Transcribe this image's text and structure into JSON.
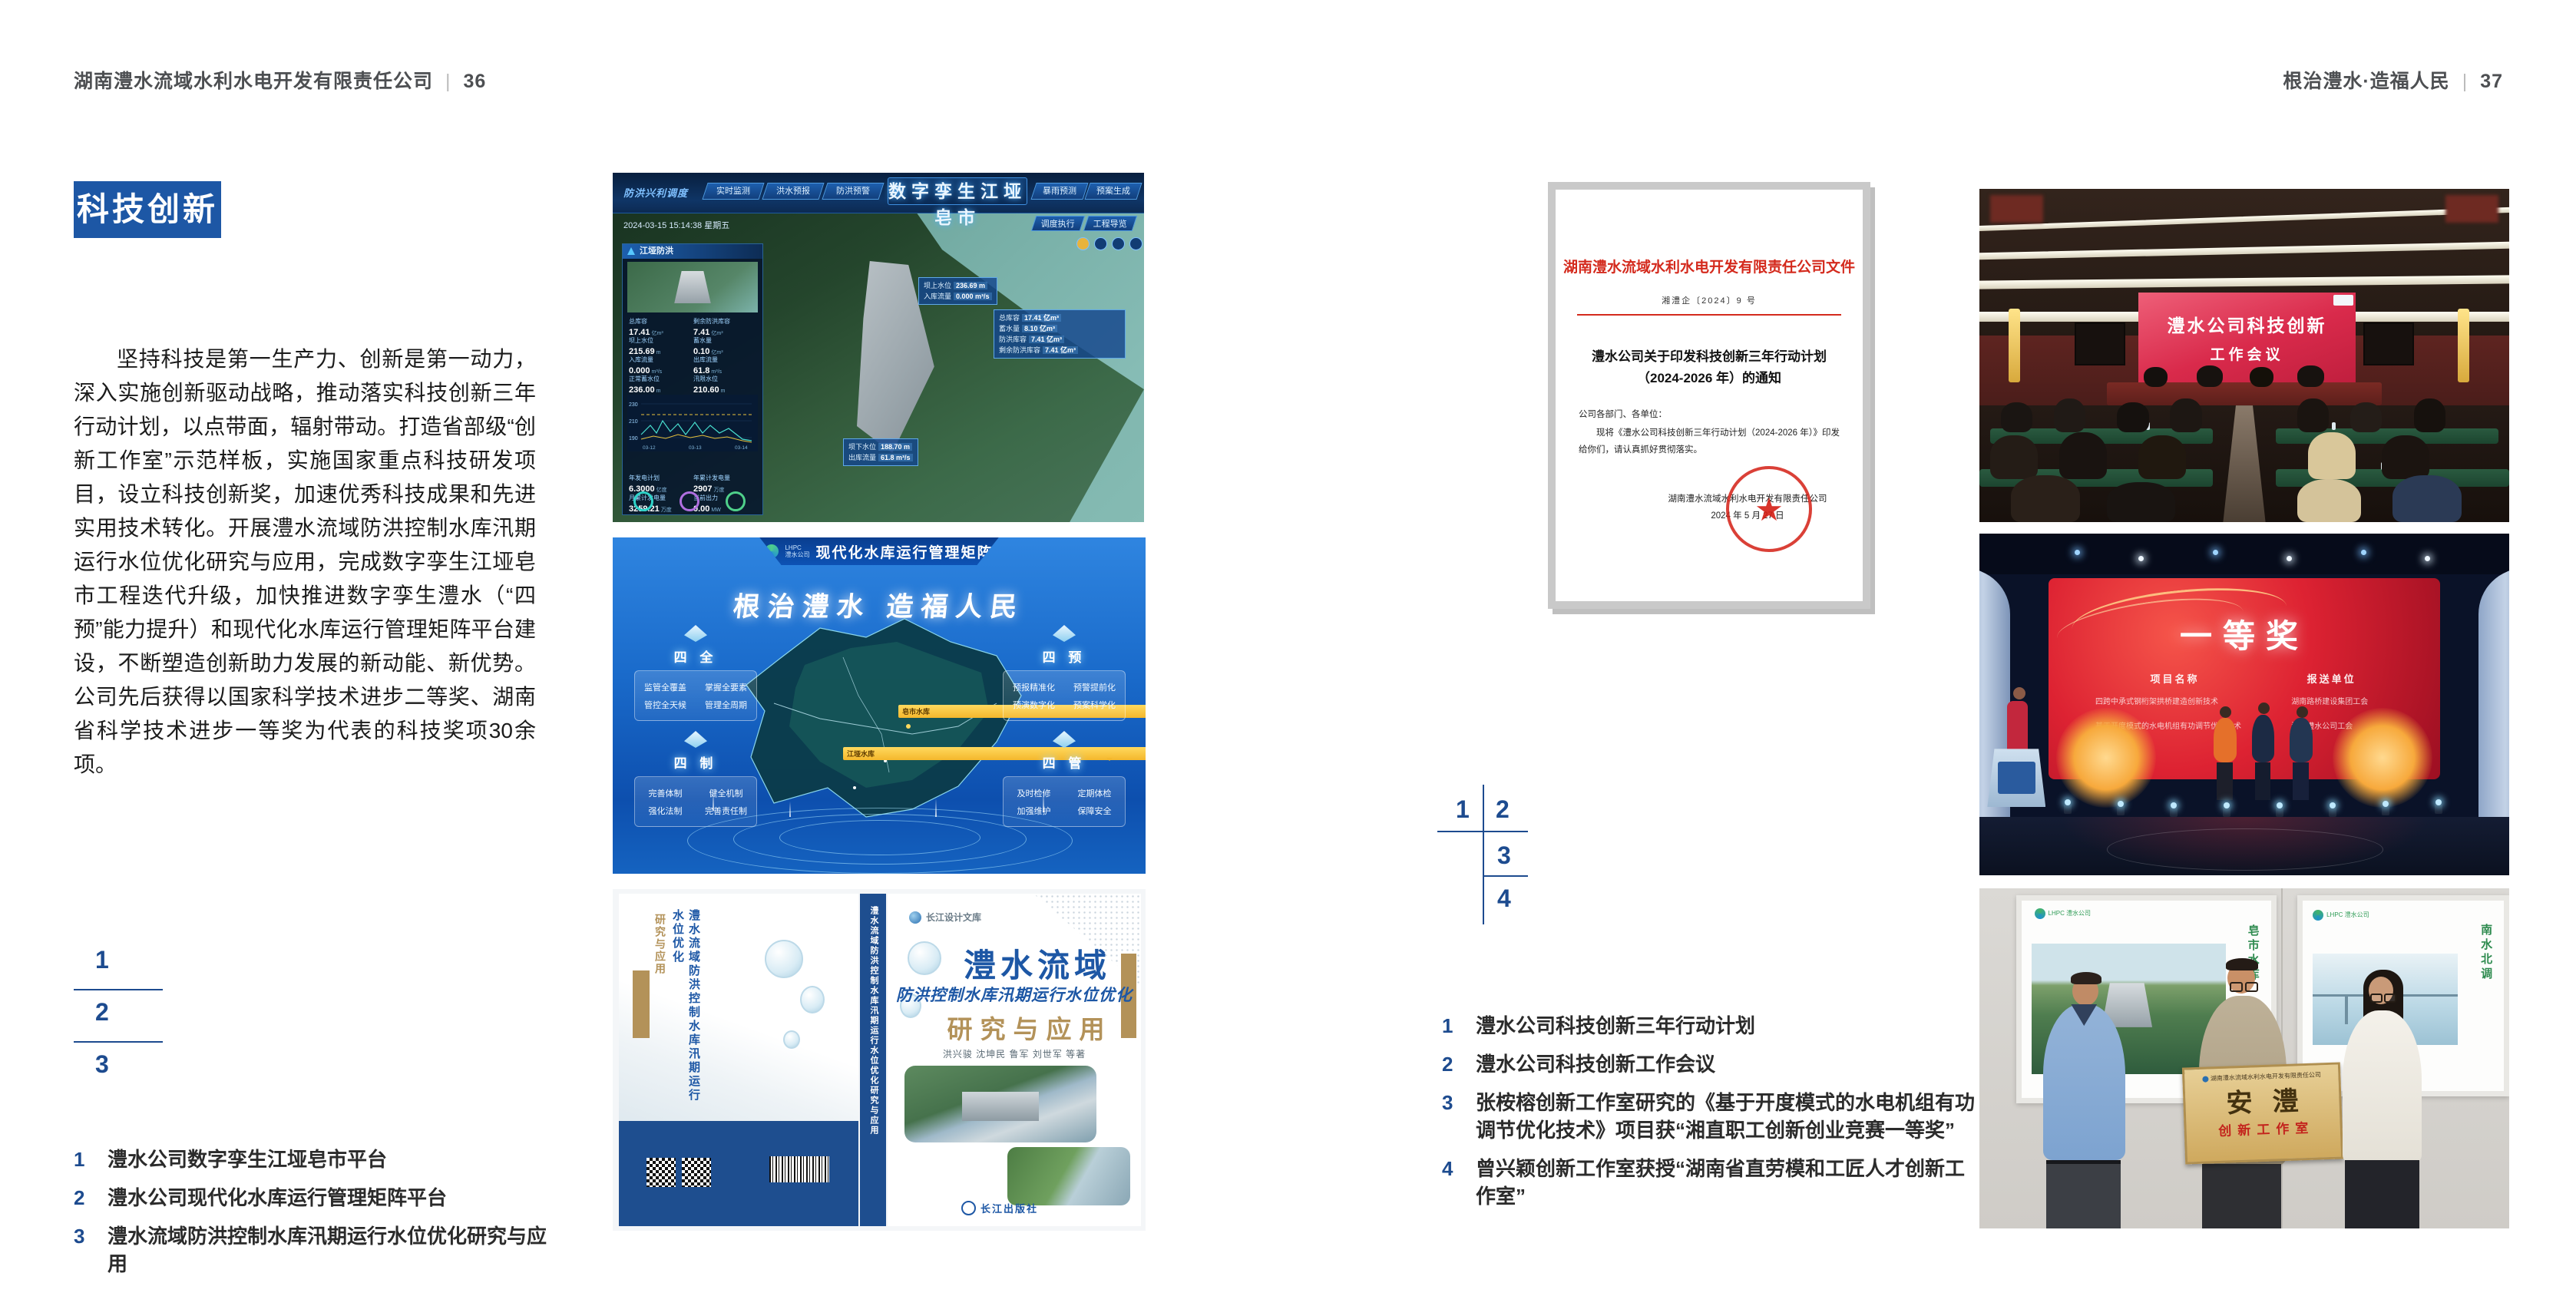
{
  "spread": {
    "left": {
      "header": {
        "title": "湖南澧水流域水利水电开发有限责任公司",
        "sep": "|",
        "page": "36"
      },
      "section_tag": "科技创新",
      "paragraph": "坚持科技是第一生产力、创新是第一动力，深入实施创新驱动战略，推动落实科技创新三年行动计划，以点带面，辐射带动。打造省部级“创新工作室”示范样板，实施国家重点科技研发项目，设立科技创新奖，加速优秀科技成果和先进实用技术转化。开展澧水流域防洪控制水库汛期运行水位优化研究与应用，完成数字孪生江垭皂市工程迭代升级，加快推进数字孪生澧水（“四预”能力提升）和现代化水库运行管理矩阵平台建设，不断塑造创新助力发展的新动能、新优势。公司先后获得以国家科学技术进步二等奖、湖南省科学技术进步一等奖为代表的科技奖项30余项。",
      "figure_nums": [
        "1",
        "2",
        "3"
      ],
      "captions": [
        {
          "num": "1",
          "text": "澧水公司数字孪生江垭皂市平台"
        },
        {
          "num": "2",
          "text": "澧水公司现代化水库运行管理矩阵平台"
        },
        {
          "num": "3",
          "text": "澧水流域防洪控制水库汛期运行水位优化研究与应用"
        }
      ]
    },
    "right": {
      "header": {
        "title": "根治澧水·造福人民",
        "sep": "|",
        "page": "37"
      },
      "figure_nums": [
        "1",
        "2",
        "3",
        "4"
      ],
      "captions": [
        {
          "num": "1",
          "text": "澧水公司科技创新三年行动计划"
        },
        {
          "num": "2",
          "text": "澧水公司科技创新工作会议"
        },
        {
          "num": "3",
          "text": "张桉榕创新工作室研究的《基于开度模式的水电机组有功调节优化技术》项目获“湘直职工创新创业竞赛一等奖”"
        },
        {
          "num": "4",
          "text": "曾兴颖创新工作室获授“湖南省直劳模和工匠人才创新工作室”"
        }
      ]
    }
  },
  "figures": {
    "dashboard": {
      "title": "数字孪生江垭皂市",
      "corner_label": "防洪兴利调度",
      "tabs_left": [
        "实时监测",
        "洪水预报",
        "防洪预警"
      ],
      "tabs_right": [
        "暴雨预测",
        "预案生成",
        "调度执行",
        "工程导览"
      ],
      "timestamp": "2024-03-15 15:14:38 星期五",
      "panel1_title": "江垭防洪",
      "stats": [
        {
          "label": "总库容",
          "value": "17.41",
          "unit": "亿m³"
        },
        {
          "label": "剩余防洪库容",
          "value": "7.41",
          "unit": "亿m³"
        },
        {
          "label": "坝上水位",
          "value": "215.69",
          "unit": "m"
        },
        {
          "label": "蓄水量",
          "value": "0.10",
          "unit": "亿m³"
        },
        {
          "label": "入库流量",
          "value": "0.000",
          "unit": "m³/s"
        },
        {
          "label": "出库流量",
          "value": "61.8",
          "unit": "m³/s"
        },
        {
          "label": "正常蓄水位",
          "value": "236.00",
          "unit": "m"
        },
        {
          "label": "汛限水位",
          "value": "210.60",
          "unit": "m"
        }
      ],
      "chart_y": [
        "230",
        "210",
        "190"
      ],
      "chart_x": [
        "03-12",
        "03-13",
        "03-14"
      ],
      "panel2_title": "江垭发电",
      "stats2": [
        {
          "label": "年发电计划",
          "value": "6.3000",
          "unit": "亿度"
        },
        {
          "label": "年累计发电量",
          "value": "2907",
          "unit": "万度"
        },
        {
          "label": "月累计发电量",
          "value": "3259.21",
          "unit": "万度"
        },
        {
          "label": "当前出力",
          "value": "0.00",
          "unit": "MW"
        }
      ],
      "tag_up": {
        "l1": "坝上水位",
        "v1": "236.69 m",
        "l2": "入库流量",
        "v2": "0.000 m³/s"
      },
      "tag_info": [
        {
          "label": "总库容",
          "value": "17.41 亿m³"
        },
        {
          "label": "蓄水量",
          "value": "8.10 亿m³"
        },
        {
          "label": "防洪库容",
          "value": "7.41 亿m³"
        },
        {
          "label": "剩余防洪库容",
          "value": "7.41 亿m³"
        }
      ],
      "tag_down": {
        "l1": "坝下水位",
        "v1": "188.70 m",
        "l2": "出库流量",
        "v2": "61.8 m³/s"
      }
    },
    "matrix": {
      "logo_line1": "LHPC",
      "logo_line2": "澧水公司",
      "title": "现代化水库运行管理矩阵",
      "slogan": "根治澧水 造福人民",
      "pins": [
        "皂市水库",
        "江垭水库"
      ],
      "groups": [
        {
          "name": "四 全",
          "items": [
            "监管全覆盖",
            "掌握全要素",
            "管控全天候",
            "管理全周期"
          ]
        },
        {
          "name": "四 预",
          "items": [
            "预报精准化",
            "预警提前化",
            "预演数字化",
            "预案科学化"
          ]
        },
        {
          "name": "四 制",
          "items": [
            "完善体制",
            "健全机制",
            "强化法制",
            "完善责任制"
          ]
        },
        {
          "name": "四 管",
          "items": [
            "及时检修",
            "定期体检",
            "加强维护",
            "保障安全"
          ]
        }
      ]
    },
    "book": {
      "series": "长江设计文库",
      "title1": "澧水流域",
      "title2": "防洪控制水库汛期运行水位优化",
      "title3": "研究与应用",
      "authors": "洪兴骏  沈坤民  鲁军  刘世军  等著",
      "publisher": "长江出版社",
      "spine_text": "澧水流域防洪控制水库汛期运行水位优化研究与应用",
      "back_title": "澧水流域防洪控制水库汛期运行水位优化",
      "back_sub": "研究与应用"
    },
    "document": {
      "header": "湖南澧水流域水利水电开发有限责任公司文件",
      "doc_no": "湘澧企〔2024〕9 号",
      "title_line1": "澧水公司关于印发科技创新三年行动计划",
      "title_line2": "（2024-2026 年）的通知",
      "salutation": "公司各部门、各单位：",
      "body": "现将《澧水公司科技创新三年行动计划（2024-2026 年）》印发给你们，请认真抓好贯彻落实。",
      "signer": "湖南澧水流域水利水电开发有限责任公司",
      "date": "2024 年 5 月 27 日",
      "star": "★"
    },
    "meeting": {
      "screen_line1": "澧水公司科技创新",
      "screen_line2": "工作会议"
    },
    "award": {
      "title": "一等奖",
      "col1": "项目名称",
      "col2": "报送单位",
      "rows": [
        {
          "project": "四跨中承式钢桁架拱桥建造创新技术",
          "org": "湖南路桥建设集团工会"
        },
        {
          "project": "基于开度模式的水电机组有功调节优化技术",
          "org": "湖南澧水公司工会"
        }
      ]
    },
    "workshop": {
      "plaque_top": "湖南澧水流域水利水电开发有限责任公司",
      "plaque_main": "安澧",
      "plaque_sub": "创新工作室",
      "poster_left_label": "皂市水库",
      "poster_right_label": "南水北调",
      "logo_left": "LHPC 澧水公司",
      "logo_right": "LHPC 澧水公司"
    }
  }
}
